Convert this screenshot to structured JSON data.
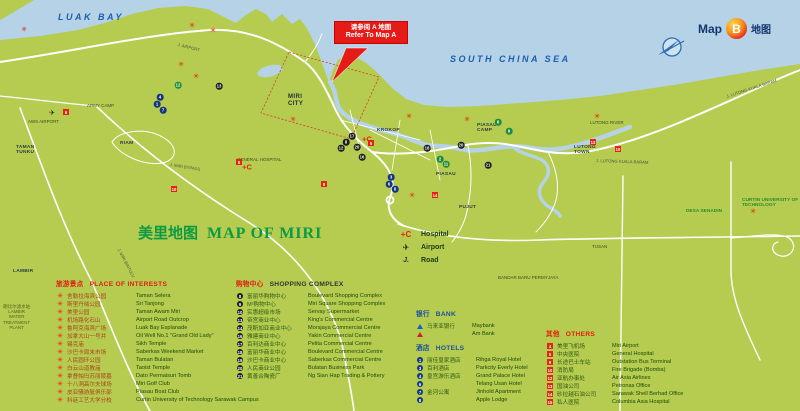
{
  "badge": {
    "map_word": "Map",
    "letter": "B",
    "zh": "地图"
  },
  "callout": {
    "line_zh": "请参阅 A 地图",
    "line_en": "Refer To Map A"
  },
  "title": {
    "zh": "美里地图",
    "en": "MAP OF MIRI"
  },
  "legend_symbols": {
    "items": [
      {
        "glyph": "+C",
        "cls": "sym-hosp",
        "icon": "hospital-cross-icon",
        "label": "Hospital"
      },
      {
        "glyph": "✈",
        "cls": "sym-plane",
        "icon": "airport-plane-icon",
        "label": "Airport"
      },
      {
        "glyph": "J.",
        "cls": "sym-road",
        "icon": "road-icon",
        "label": "Road"
      }
    ]
  },
  "legend_poi": {
    "title_zh": "旅游景点",
    "title_en": "PLACE OF INTERESTS",
    "items": [
      {
        "zh": "舍勒拉海滨公园",
        "en": "Taman Selera"
      },
      {
        "zh": "斯里丹绒公园",
        "en": "Sri Tanjong"
      },
      {
        "zh": "美里公园",
        "en": "Taman Awam Miri"
      },
      {
        "zh": "机场路化石山",
        "en": "Airport Road Outcrop"
      },
      {
        "zh": "鲁阿克海滨广场",
        "en": "Luak Bay Esplanade"
      },
      {
        "zh": "加拿大山一号井",
        "en": "Oil Well No.1 \"Grand Old Lady\""
      },
      {
        "zh": "锡克庙",
        "en": "Sikh Temple"
      },
      {
        "zh": "沙巴卡周末市场",
        "en": "Saberkas Weekend Market"
      },
      {
        "zh": "人民圆环公园",
        "en": "Taman Bulatan"
      },
      {
        "zh": "白云山道教庙",
        "en": "Taoist Temple"
      },
      {
        "zh": "拿督帕玛苏丽陵墓",
        "en": "Dato Permaisuri Tomb"
      },
      {
        "zh": "十八洞高尔夫球场",
        "en": "Miri Golf Club"
      },
      {
        "zh": "皮亚骚游艇俱乐部",
        "en": "Piasau Boat Club"
      },
      {
        "zh": "科廷工艺大学分校",
        "en": "Curtin University of Technology Sarawak Campus"
      }
    ]
  },
  "legend_shopping": {
    "title_zh": "购物中心",
    "title_en": "SHOPPING COMPLEX",
    "items": [
      {
        "n": "8",
        "zh": "富丽华购物中心",
        "en": "Boulevard Shopping Complex"
      },
      {
        "n": "9",
        "zh": "M²购物中心",
        "en": "Miri Square Shopping Complex"
      },
      {
        "n": "10",
        "zh": "实惠超级市场",
        "en": "Servay Supermarket"
      },
      {
        "n": "13",
        "zh": "帝宫商业中心",
        "en": "King's Commercial Centre"
      },
      {
        "n": "14",
        "zh": "茂斯加亚商业中心",
        "en": "Morsjaya Commercial Centre"
      },
      {
        "n": "16",
        "zh": "雅建商业中心",
        "en": "Yakin Commercial Centre"
      },
      {
        "n": "17",
        "zh": "百利达商业中心",
        "en": "Pelita Commercial Centre"
      },
      {
        "n": "18",
        "zh": "富丽华商业中心",
        "en": "Boulevard Commercial Centre"
      },
      {
        "n": "19",
        "zh": "沙巴卡商业中心",
        "en": "Saberkas Commercial Centre"
      },
      {
        "n": "20",
        "zh": "人民商业公园",
        "en": "Bulatan Business Park"
      },
      {
        "n": "21",
        "zh": "黄善合陶瓷厂",
        "en": "Ng Sian Hap Trading & Pottery"
      }
    ]
  },
  "legend_bank": {
    "title_zh": "银行",
    "title_en": "BANK",
    "items": [
      {
        "icon": "ic-maybank",
        "zh": "马来亚银行",
        "en": "Maybank"
      },
      {
        "icon": "ic-ambank",
        "zh": "",
        "en": "Am Bank"
      }
    ]
  },
  "legend_hotels": {
    "title_zh": "酒店",
    "title_en": "HOTELS",
    "items": [
      {
        "n": "1",
        "zh": "丽佳皇家酒店",
        "en": "Rihga Royal Hotel"
      },
      {
        "n": "3",
        "zh": "百利酒店",
        "en": "Parkcity Everly Hotel"
      },
      {
        "n": "4",
        "zh": "皇宫游乐酒店",
        "en": "Grand Palace Hotel"
      },
      {
        "n": "6",
        "zh": "",
        "en": "Telang Usan Hotel"
      },
      {
        "n": "7",
        "zh": "金河公寓",
        "en": "Jinhold Apartment"
      },
      {
        "n": "8",
        "zh": "",
        "en": "Apple Lodge"
      }
    ]
  },
  "legend_others": {
    "title_zh": "其他",
    "title_en": "OTHERS",
    "items": [
      {
        "n": "4",
        "zh": "美里飞机场",
        "en": "Miri Airport"
      },
      {
        "n": "5",
        "zh": "中央医院",
        "en": "General Hospital"
      },
      {
        "n": "9",
        "zh": "长途巴士车站",
        "en": "Outstation Bus Terminal"
      },
      {
        "n": "10",
        "zh": "消防局",
        "en": "Fire Brigade (Bomba)"
      },
      {
        "n": "12",
        "zh": "亚航办事处",
        "en": "Air Asia Airlines"
      },
      {
        "n": "13",
        "zh": "国油公司",
        "en": "Petronas Office"
      },
      {
        "n": "14",
        "zh": "砂拉越石油公司",
        "en": "Sarawak Shell Berhad Office"
      },
      {
        "n": "15",
        "zh": "私人医院",
        "en": "Columbia Asia Hospital"
      }
    ]
  },
  "map": {
    "colors": {
      "sea": "#b5d2e6",
      "land": "#b5cc50",
      "road": "#ffffff",
      "accent_red": "#e8220e"
    },
    "labels": [
      {
        "text": "LUAK BAY",
        "x": 58,
        "y": 13,
        "cls": "sea"
      },
      {
        "text": "SOUTH CHINA SEA",
        "x": 450,
        "y": 55,
        "cls": "sea"
      },
      {
        "text": "MIRI\nCITY",
        "x": 288,
        "y": 94,
        "cls": "town"
      },
      {
        "text": "KROKOP",
        "x": 377,
        "y": 128,
        "cls": "town-sm"
      },
      {
        "text": "PIASAU",
        "x": 436,
        "y": 172,
        "cls": "town-sm"
      },
      {
        "text": "PIASAU\nCAMP",
        "x": 477,
        "y": 123,
        "cls": "town-sm"
      },
      {
        "text": "PUJUT",
        "x": 459,
        "y": 205,
        "cls": "town-sm"
      },
      {
        "text": "LUTONG\nTOWN",
        "x": 574,
        "y": 145,
        "cls": "town-sm"
      },
      {
        "text": "LUTONG RIVER",
        "x": 590,
        "y": 121,
        "cls": "tiny"
      },
      {
        "text": "ARMY CAMP",
        "x": 87,
        "y": 104,
        "cls": "tiny"
      },
      {
        "text": "TAMAN\nTUNKU",
        "x": 16,
        "y": 145,
        "cls": "town-sm"
      },
      {
        "text": "AWS AIRPORT",
        "x": 28,
        "y": 120,
        "cls": "tiny"
      },
      {
        "text": "GENERAL HOSPITAL",
        "x": 237,
        "y": 158,
        "cls": "tiny"
      },
      {
        "text": "RIAM",
        "x": 120,
        "y": 141,
        "cls": "town-sm"
      },
      {
        "text": "LAMBIR",
        "x": 13,
        "y": 269,
        "cls": "town-sm"
      },
      {
        "text": "DESA SENADIN",
        "x": 686,
        "y": 209,
        "cls": "town-green"
      },
      {
        "text": "CURTIN UNIVERSITY OF\nTECHNOLOGY",
        "x": 742,
        "y": 198,
        "cls": "town-green"
      },
      {
        "text": "TUSAN",
        "x": 592,
        "y": 245,
        "cls": "tiny"
      },
      {
        "text": "BANDAR BARU PERMYJAYA",
        "x": 498,
        "y": 276,
        "cls": "tiny"
      },
      {
        "text": "朗比尔滤水站\nLAMBIR\nWATER\nTREATMENT\nPLANT",
        "x": 3,
        "y": 304,
        "cls": "wtp"
      },
      {
        "text": "J. AIRPORT",
        "x": 178,
        "y": 43,
        "cls": "road-lbl",
        "rot": 14
      },
      {
        "text": "J. MIRI BYPASS",
        "x": 170,
        "y": 163,
        "cls": "road-lbl",
        "rot": 9
      },
      {
        "text": "J. LUTONG KUALA BARAM",
        "x": 596,
        "y": 159,
        "cls": "road-lbl",
        "rot": 2
      },
      {
        "text": "J. LUTONG KUALA BARAM",
        "x": 726,
        "y": 95,
        "cls": "road-lbl",
        "rot": -18
      },
      {
        "text": "J. MIRI BINTULU",
        "x": 120,
        "y": 248,
        "cls": "road-lbl",
        "rot": 62
      }
    ],
    "markers": [
      {
        "t": "flower",
        "x": 24,
        "y": 30
      },
      {
        "t": "flower",
        "x": 192,
        "y": 26
      },
      {
        "t": "flower",
        "x": 213,
        "y": 31
      },
      {
        "t": "flower",
        "x": 181,
        "y": 65
      },
      {
        "t": "flower",
        "x": 196,
        "y": 77
      },
      {
        "t": "flower",
        "x": 293,
        "y": 120
      },
      {
        "t": "flower",
        "x": 409,
        "y": 117
      },
      {
        "t": "flower",
        "x": 467,
        "y": 120
      },
      {
        "t": "flower",
        "x": 597,
        "y": 117
      },
      {
        "t": "flower",
        "x": 412,
        "y": 196
      },
      {
        "t": "flower",
        "x": 753,
        "y": 212
      },
      {
        "t": "shop",
        "x": 352,
        "y": 136,
        "n": "17"
      },
      {
        "t": "shop",
        "x": 346,
        "y": 142,
        "n": "8"
      },
      {
        "t": "shop",
        "x": 341,
        "y": 148,
        "n": "12"
      },
      {
        "t": "shop",
        "x": 357,
        "y": 147,
        "n": "20"
      },
      {
        "t": "shop",
        "x": 362,
        "y": 157,
        "n": "16"
      },
      {
        "t": "shop",
        "x": 427,
        "y": 148,
        "n": "18"
      },
      {
        "t": "shop",
        "x": 461,
        "y": 145,
        "n": "20"
      },
      {
        "t": "shop",
        "x": 488,
        "y": 165,
        "n": "21"
      },
      {
        "t": "shop",
        "x": 219,
        "y": 86,
        "n": "13"
      },
      {
        "t": "hotel",
        "x": 160,
        "y": 97,
        "n": "4"
      },
      {
        "t": "hotel",
        "x": 157,
        "y": 104,
        "n": "1"
      },
      {
        "t": "hotel",
        "x": 163,
        "y": 110,
        "n": "7"
      },
      {
        "t": "hotel",
        "x": 391,
        "y": 177,
        "n": "3"
      },
      {
        "t": "hotel",
        "x": 389,
        "y": 184,
        "n": "6"
      },
      {
        "t": "hotel",
        "x": 395,
        "y": 189,
        "n": "8"
      },
      {
        "t": "green",
        "x": 178,
        "y": 85,
        "n": "12"
      },
      {
        "t": "green",
        "x": 498,
        "y": 122,
        "n": "6"
      },
      {
        "t": "green",
        "x": 509,
        "y": 131,
        "n": "9"
      },
      {
        "t": "green",
        "x": 446,
        "y": 164,
        "n": "11"
      },
      {
        "t": "green",
        "x": 440,
        "y": 159,
        "n": "2"
      },
      {
        "t": "other",
        "x": 66,
        "y": 112,
        "n": "6"
      },
      {
        "t": "other",
        "x": 239,
        "y": 162,
        "n": "5"
      },
      {
        "t": "other",
        "x": 174,
        "y": 189,
        "n": "10"
      },
      {
        "t": "other",
        "x": 324,
        "y": 184,
        "n": "8"
      },
      {
        "t": "other",
        "x": 593,
        "y": 142,
        "n": "13"
      },
      {
        "t": "other",
        "x": 618,
        "y": 149,
        "n": "10"
      },
      {
        "t": "other",
        "x": 435,
        "y": 195,
        "n": "14"
      },
      {
        "t": "other",
        "x": 371,
        "y": 143,
        "n": "5"
      },
      {
        "t": "hosp",
        "x": 247,
        "y": 167
      },
      {
        "t": "hosp",
        "x": 367,
        "y": 139
      },
      {
        "t": "plane",
        "x": 52,
        "y": 113
      }
    ]
  }
}
